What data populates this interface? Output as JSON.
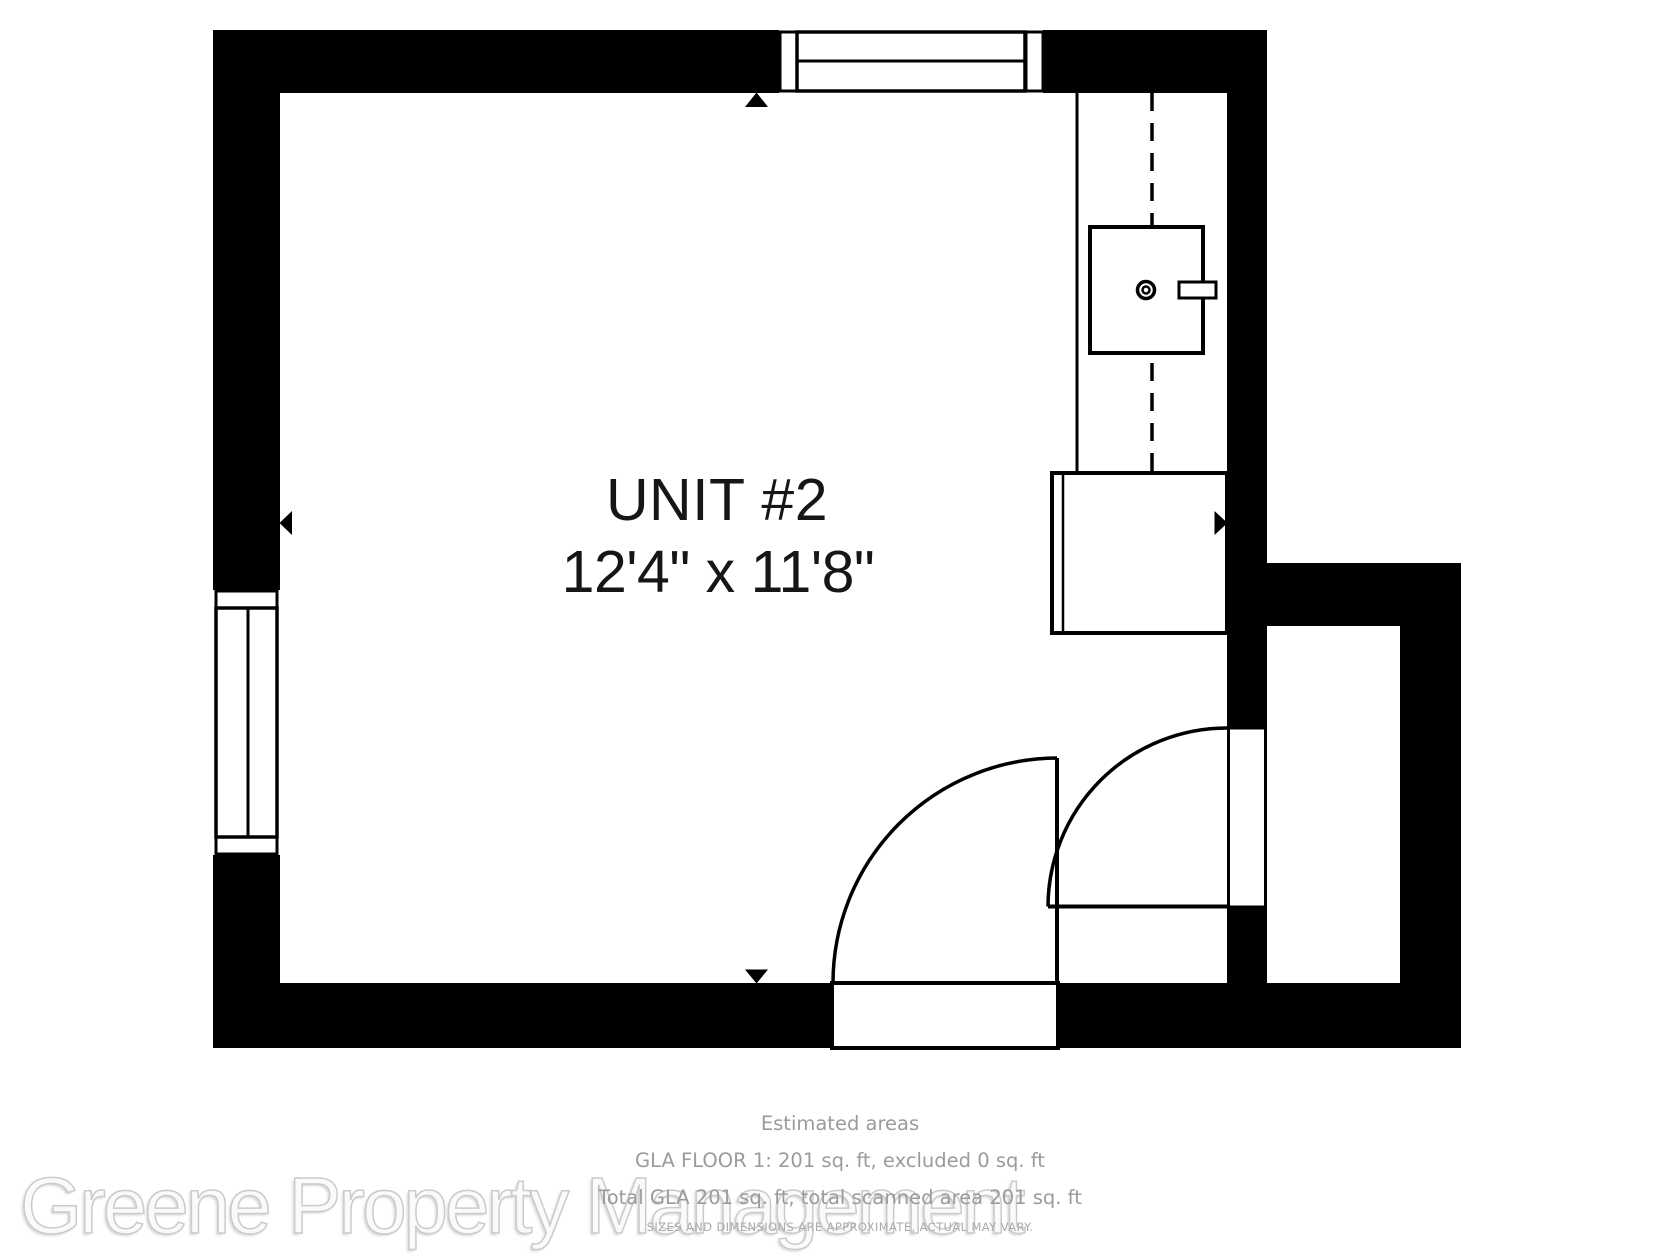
{
  "room": {
    "unit_label": "UNIT #2",
    "dimensions": "12'4\" x 11'8\""
  },
  "footer": {
    "heading": "Estimated areas",
    "gla_floor_line": "GLA FLOOR 1: 201 sq. ft, excluded 0 sq. ft",
    "total_gla_line": "Total GLA 201 sq. ft, total scanned area 201 sq. ft",
    "disclaimer": "SIZES AND DIMENSIONS ARE APPROXIMATE, ACTUAL MAY VARY."
  },
  "watermark": {
    "text": "Greene Property Management"
  },
  "icons": {
    "scan_marker_up": "scan-center-arrow-up",
    "scan_marker_down": "scan-center-arrow-down",
    "scan_marker_left": "scan-center-arrow-left",
    "scan_marker_right": "scan-center-arrow-right",
    "water_heater": "water-heater-fixture",
    "door_swing": "door-swing-arc"
  },
  "colors": {
    "wall": "#000000",
    "background": "#ffffff",
    "footer_text": "#9b9b9b",
    "watermark_fill": "#fafafa",
    "watermark_outline": "#cbcbcb"
  }
}
